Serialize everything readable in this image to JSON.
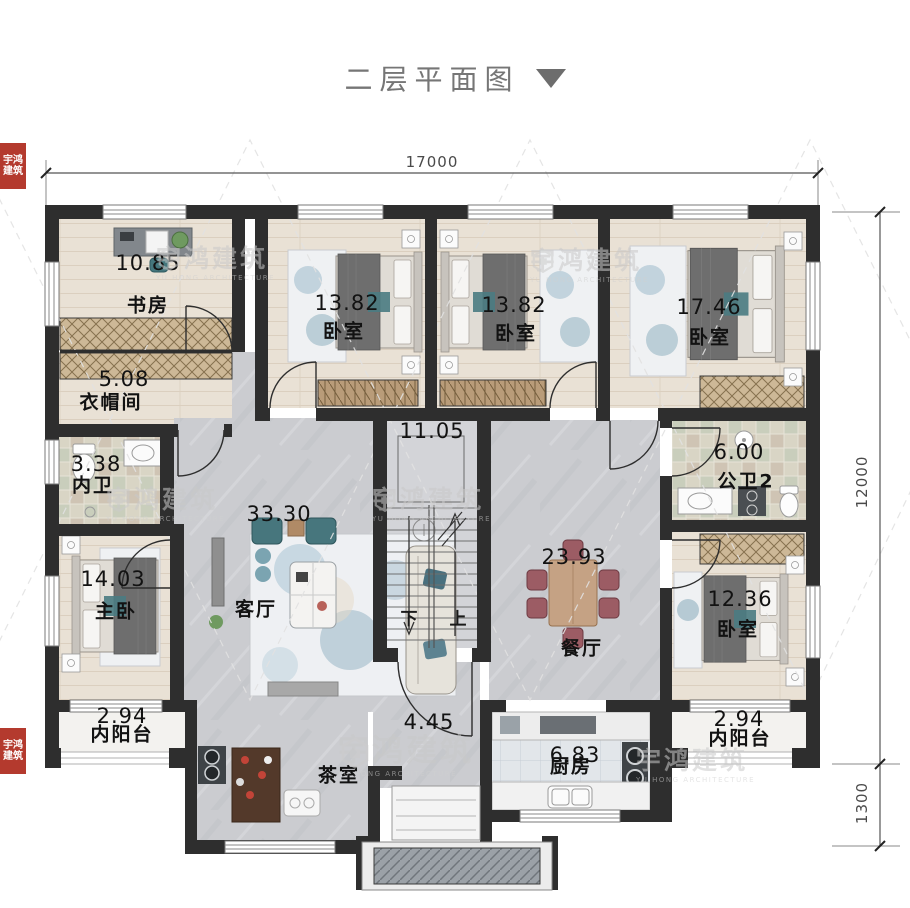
{
  "title": {
    "text": "二层平面图"
  },
  "dims": {
    "top_width": "17000",
    "right_height": "12000",
    "right_lower": "1300"
  },
  "stairs": {
    "down": "下",
    "up": "上"
  },
  "rooms": {
    "study": {
      "name": "书房",
      "area": "10.85"
    },
    "bedroom1": {
      "name": "卧室",
      "area": "13.82"
    },
    "bedroom2": {
      "name": "卧室",
      "area": "13.82"
    },
    "bedroom3": {
      "name": "卧室",
      "area": "17.46"
    },
    "cloakroom": {
      "name": "衣帽间",
      "area": "5.08"
    },
    "ensuite": {
      "name": "内卫",
      "area": "3.38"
    },
    "publicbath": {
      "name": "公卫2",
      "area": "6.00"
    },
    "master": {
      "name": "主卧",
      "area": "14.03"
    },
    "living": {
      "name": "客厅",
      "area": "33.30"
    },
    "stairwell": {
      "area": "11.05"
    },
    "dining": {
      "name": "餐厅",
      "area": "23.93"
    },
    "bedroom4": {
      "name": "卧室",
      "area": "12.36"
    },
    "balcony_left": {
      "name": "内阳台",
      "area": "2.94"
    },
    "tea": {
      "name": "茶室",
      "area": "4.45"
    },
    "kitchen": {
      "name": "厨房",
      "area": "6.83"
    },
    "balcony_right": {
      "name": "内阳台",
      "area": "2.94"
    }
  },
  "watermark": {
    "cn": "宇鸿建筑",
    "en": "YU HONG ARCHITECTURE"
  },
  "colors": {
    "wall": "#2e2e2e",
    "wood": "#e9e1d5",
    "marble": "#cbccd0",
    "accent_red": "#b43a2e"
  }
}
